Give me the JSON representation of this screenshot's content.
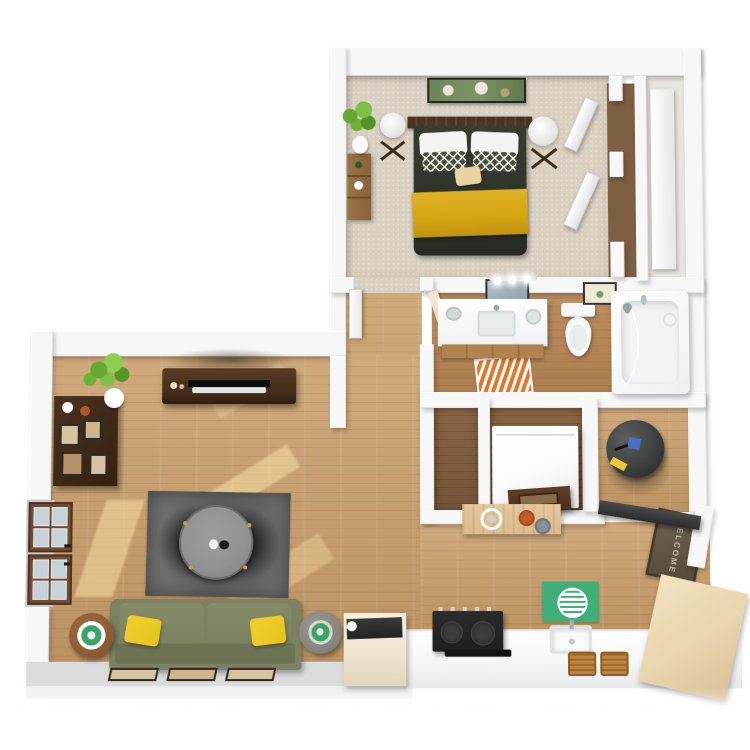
{
  "scene": {
    "type": "3d-floor-plan-render",
    "description": "Top-down 3D rendering of a one-bedroom apartment: bedroom with bed and closets (top), bathroom (middle right), hallway and storage closets (center), open living room (left), kitchen with counters (bottom right), entry door with mat (right)."
  },
  "entry": {
    "mat_text": "WELCOME"
  },
  "palette": {
    "wall": "#f7f7f7",
    "wallFace": "#dcdcdc",
    "carpet": "#d9d0c1",
    "wood": "#d0aa7d",
    "woodDeep": "#bb9262",
    "woodDark": "#8a6644",
    "duvet": "#2f332b",
    "blanket": "#d5a413",
    "pillowWhite": "#f3f3f1",
    "pillowAccent": "#474d39",
    "pillowTan": "#e9d3a2",
    "headboard": "#4b3424",
    "artGreen": "#7c9464",
    "furnitureDark": "#432c1a",
    "shelfWood": "#9a7448",
    "sofa": "#7c8161",
    "sofaShade": "#6d7254",
    "pillowYellow": "#e5c31f",
    "rug": "#6e6e6e",
    "rugDark": "#3c3c3c",
    "tableTop": "#909392",
    "tableBase": "#272727",
    "sideWood": "#8a5a34",
    "trayGreen": "#3ba368",
    "doorBrown": "#6f4c34",
    "glass": "#c6d2d8",
    "counter": "#f4f5f6",
    "vanityWood": "#b28351",
    "orange": "#e1772c",
    "washer": "#fbfbfb",
    "heater": "#3e403f",
    "heaterLabel": "#e8c83a",
    "heaterBlue": "#4a6fc0",
    "consoleWood": "#dcba8c",
    "cupOrange": "#c05a2a",
    "cupGray": "#8a9098",
    "matBrown": "#6f6352",
    "matText": "#d8cdbb",
    "greenMat": "#3fae78",
    "stove": "#1e1e1e",
    "wicker": "#bd8440",
    "beigeCab": "#e9d5ae",
    "cream": "#efe6d2",
    "plant": "#67a832"
  }
}
